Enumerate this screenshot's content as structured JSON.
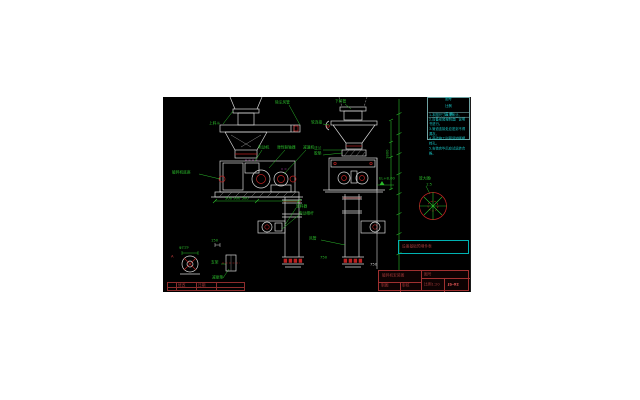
{
  "colors": {
    "canvas_bg": "#000000",
    "line_white": "#d9d9d9",
    "line_grey": "#8a8a8a",
    "annotation_green": "#2bbb2b",
    "notes_cyan": "#1ad0d0",
    "detail_red": "#bb2222",
    "title_block_red": "#a03030",
    "bright_red": "#ef5a5a",
    "magenta": "#bb44bb"
  },
  "drawing": {
    "labels": {
      "hopper": "上料斗",
      "base": "破碎机底座",
      "motor": "电动机",
      "coupling": "弹性联轴器",
      "reducer": "减速机",
      "dust_duct": "除尘风管",
      "down_pipe": "下料管",
      "soft_joint": "软连接",
      "flange": "法兰",
      "gasket": "胶垫",
      "valve": "卸料器",
      "push_rod": "电动推杆",
      "air_duct": "风管",
      "el_mark": "EL+8.00",
      "detail_title": "放大图Ⅰ",
      "detail_scale": "1:5",
      "support": "支架",
      "damper": "减振垫",
      "dia": "φ219",
      "dim_150": "150",
      "dims_left": "500  900  500",
      "dim_right": "1800",
      "bottom_750": "750",
      "ref_750": "750",
      "section_a": "A"
    },
    "notes": {
      "header_top1": "图号",
      "header_top2": "比例",
      "header": "说 明",
      "items": [
        "1.本图尺寸以毫米计。",
        "2.设备安装按制造厂说明书进行。",
        "3.管道连接处应密封不得漏灰。",
        "4.基础施工时预留地脚螺栓孔。",
        "5.安装完毕后应试运转合格。"
      ]
    },
    "schedule_title": "设备基础预埋件表",
    "title_block": {
      "project": "破碎机安装图",
      "no_label": "图号",
      "drafter": "制图",
      "checker": "审核",
      "scale": "比例1:20",
      "number": "JS-02"
    },
    "revision": {
      "cell1": "修改",
      "cell2": "日期"
    }
  }
}
